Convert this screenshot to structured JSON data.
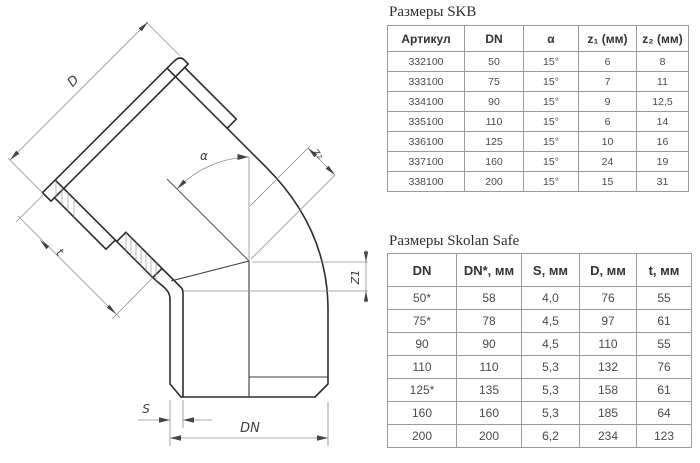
{
  "drawing": {
    "labels": {
      "d": "D",
      "alpha": "α",
      "z2": "z₂",
      "z1": "Z1",
      "t": "t",
      "s": "S",
      "dn": "DN"
    }
  },
  "tables": {
    "skb": {
      "title": "Размеры SKB",
      "headers": [
        "Артикул",
        "DN",
        "α",
        "z₁ (мм)",
        "z₂ (мм)"
      ],
      "rows": [
        [
          "332100",
          "50",
          "15°",
          "6",
          "8"
        ],
        [
          "333100",
          "75",
          "15°",
          "7",
          "11"
        ],
        [
          "334100",
          "90",
          "15°",
          "9",
          "12,5"
        ],
        [
          "335100",
          "110",
          "15°",
          "6",
          "14"
        ],
        [
          "336100",
          "125",
          "15°",
          "10",
          "16"
        ],
        [
          "337100",
          "160",
          "15°",
          "24",
          "19"
        ],
        [
          "338100",
          "200",
          "15°",
          "15",
          "31"
        ]
      ]
    },
    "skolan": {
      "title": "Размеры Skolan Safe",
      "headers": [
        "DN",
        "DN*, мм",
        "S, мм",
        "D, мм",
        "t, мм"
      ],
      "rows": [
        [
          "50*",
          "58",
          "4,0",
          "76",
          "55"
        ],
        [
          "75*",
          "78",
          "4,5",
          "97",
          "61"
        ],
        [
          "90",
          "90",
          "4,5",
          "110",
          "55"
        ],
        [
          "110",
          "110",
          "5,3",
          "132",
          "76"
        ],
        [
          "125*",
          "135",
          "5,3",
          "158",
          "61"
        ],
        [
          "160",
          "160",
          "5,3",
          "185",
          "64"
        ],
        [
          "200",
          "200",
          "6,2",
          "234",
          "123"
        ]
      ]
    }
  },
  "colors": {
    "line_main": "#2d2d2d",
    "line_dim": "#909090",
    "table_border": "#9a9a9a",
    "text": "#3a3a3a"
  }
}
